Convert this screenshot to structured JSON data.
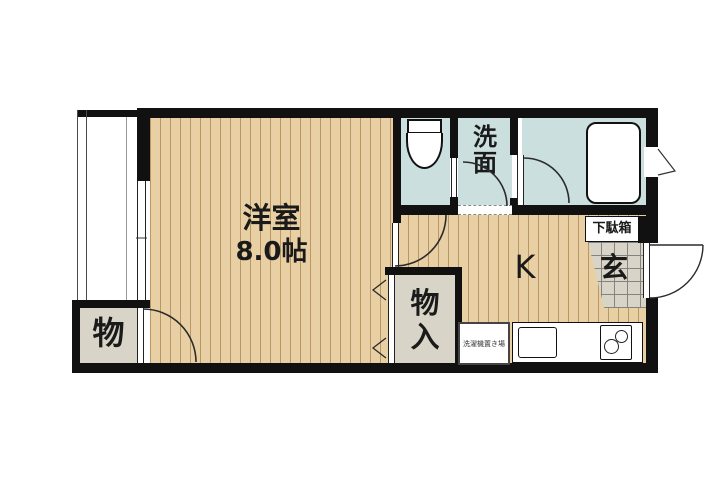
{
  "floorplan": {
    "rooms": {
      "main_room": {
        "label": "洋室",
        "size": "8.0帖"
      },
      "kitchen": {
        "label": "K"
      },
      "washroom": {
        "label": "洗面"
      },
      "entrance": {
        "label": "玄"
      },
      "shoe_cabinet": {
        "label": "下駄箱"
      },
      "storage": {
        "label": "物"
      },
      "closet": {
        "label": "物入"
      },
      "washer_space": {
        "label": "洗濯機置き場"
      }
    },
    "icons": {
      "toilet": "toilet-icon",
      "bathtub": "bathtub-icon",
      "sink": "sink-icon",
      "stove": "stove-burners-icon",
      "door_swing": "door-swing-arc",
      "window_flap": "casement-window-icon",
      "sliding_window": "sliding-window-icon"
    },
    "colors": {
      "wall": "#111111",
      "wood_floor": "#e9d0a4",
      "wood_stripe": "#926a34",
      "wet_floor": "#cbdfdf",
      "storage_fill": "#d8d4c7",
      "line": "#2b2b2b",
      "background": "#ffffff"
    }
  }
}
